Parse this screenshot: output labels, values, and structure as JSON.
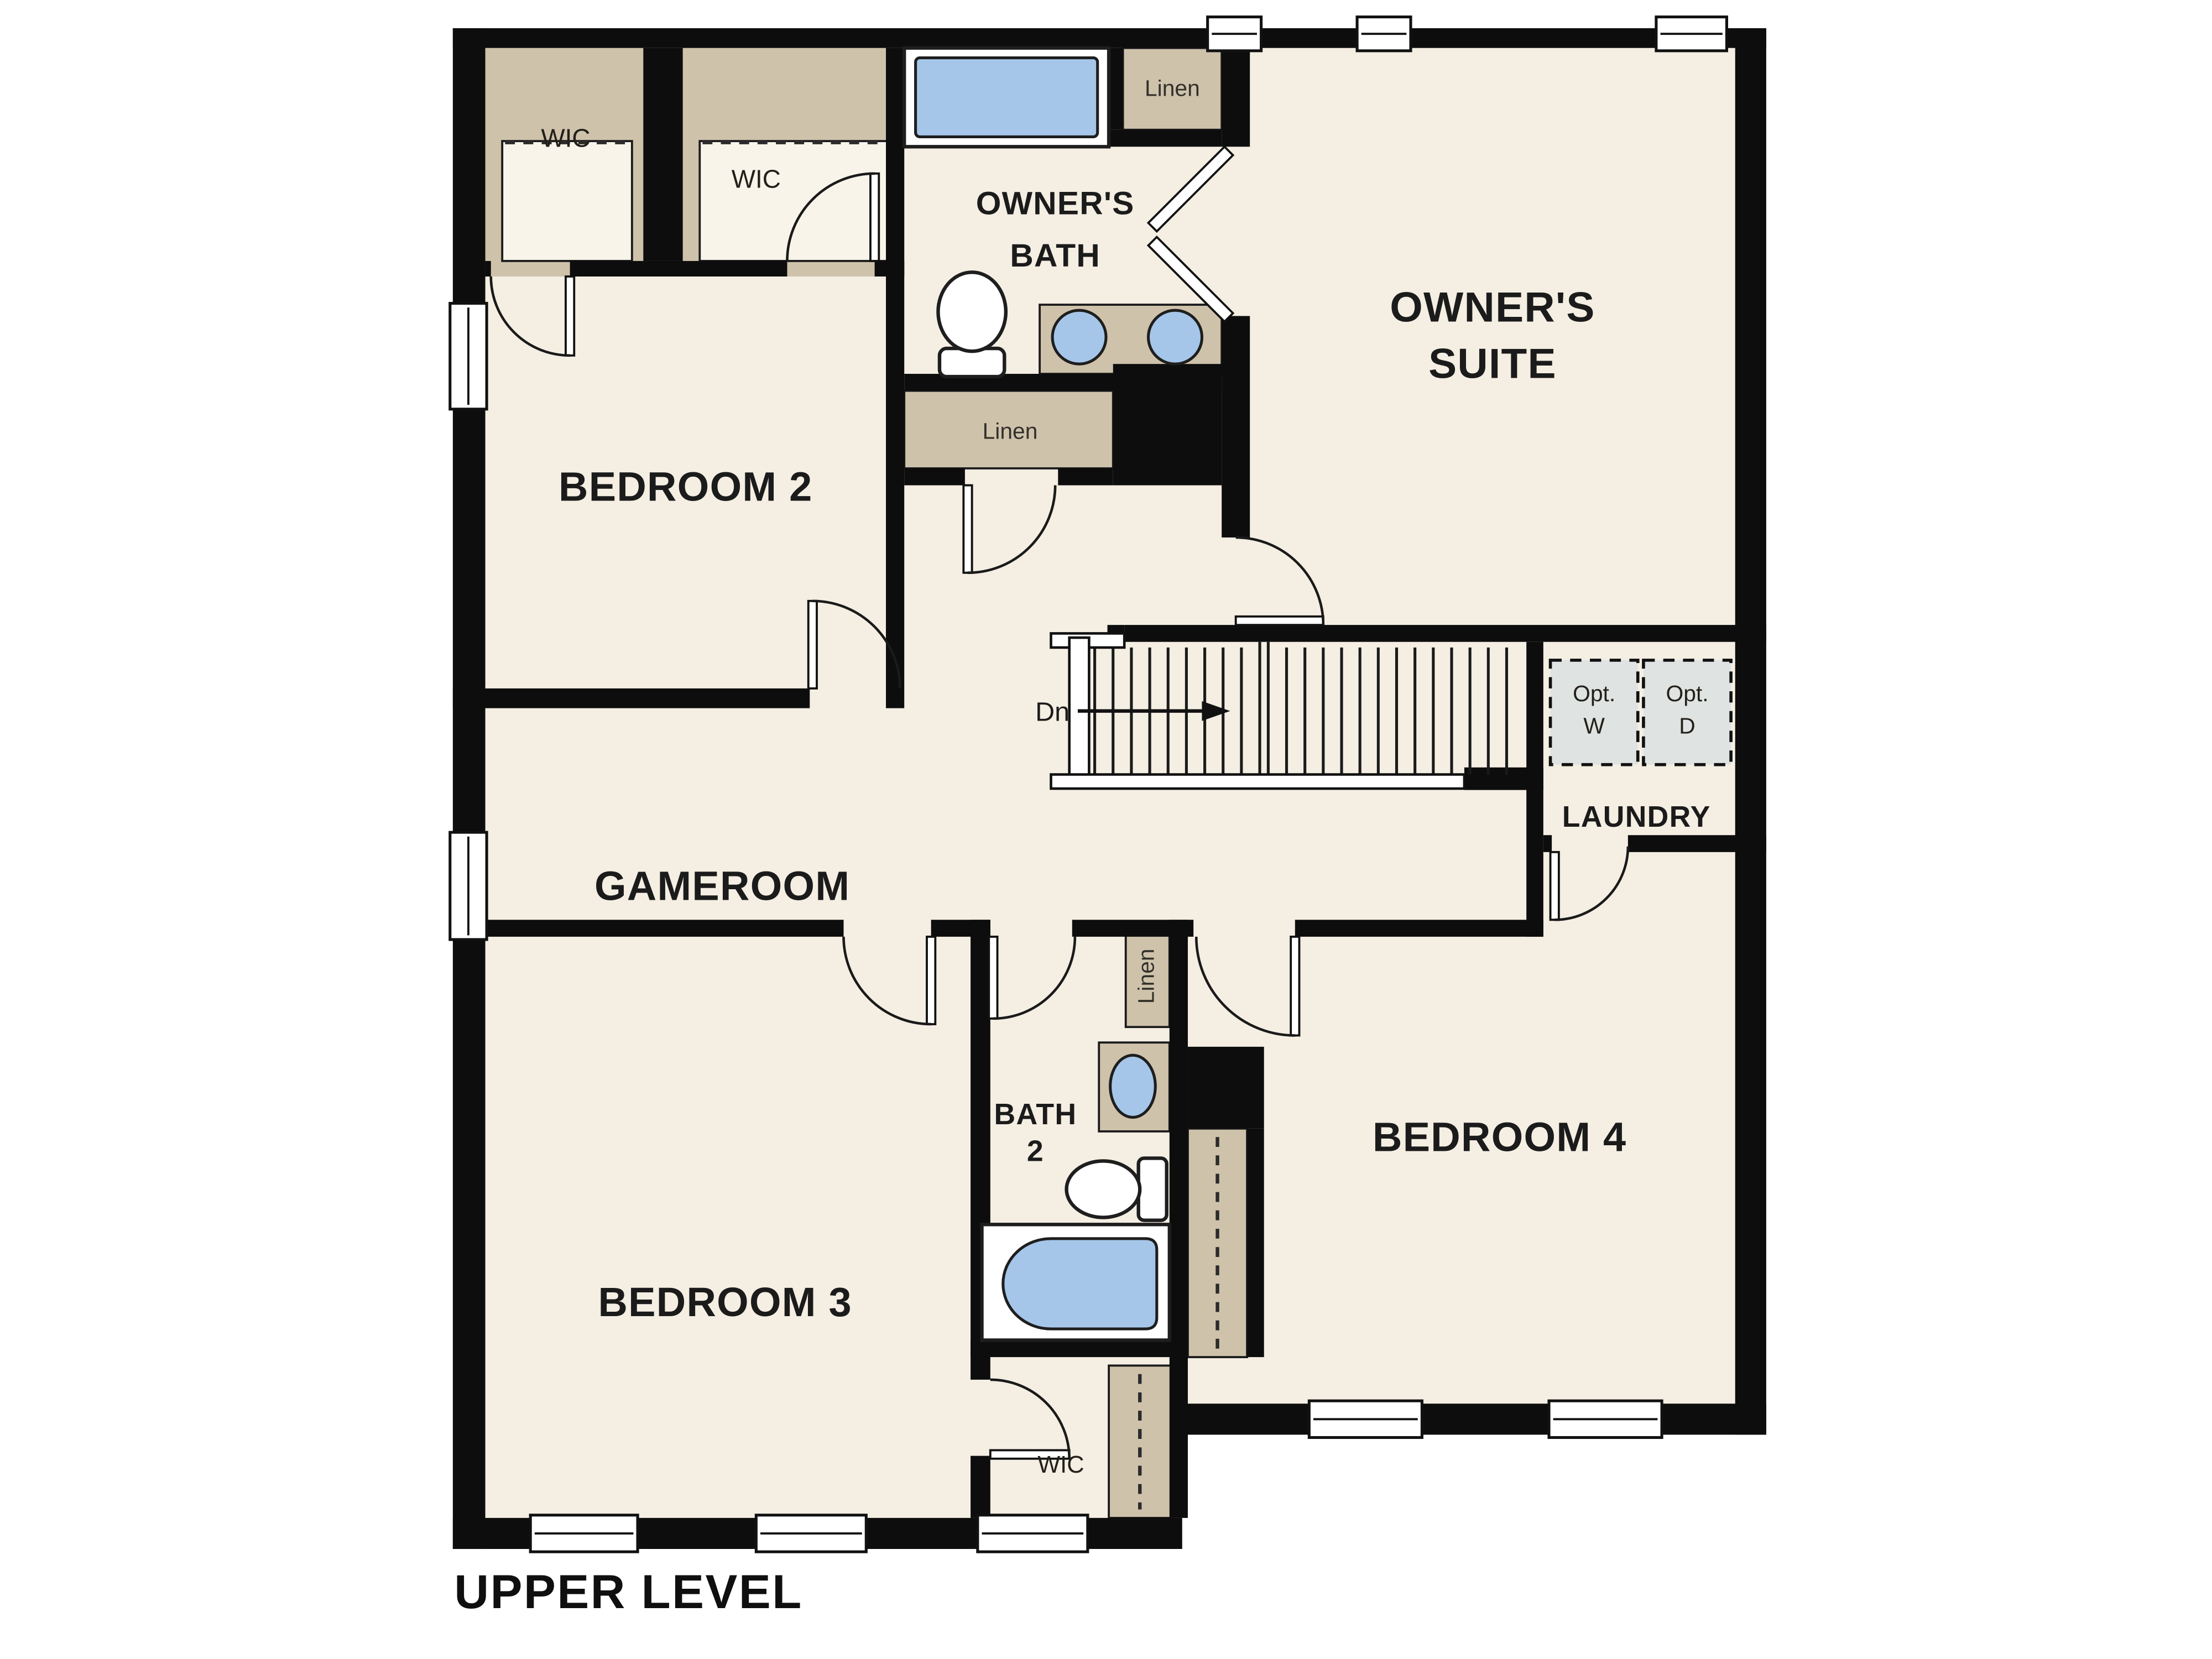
{
  "title": "UPPER LEVEL",
  "plan": {
    "rooms": {
      "owners_suite": {
        "line1": "OWNER'S",
        "line2": "SUITE"
      },
      "owners_bath": {
        "line1": "OWNER'S",
        "line2": "BATH"
      },
      "bedroom2": {
        "label": "BEDROOM 2"
      },
      "bedroom3": {
        "label": "BEDROOM 3"
      },
      "bedroom4": {
        "label": "BEDROOM 4"
      },
      "gameroom": {
        "label": "GAMEROOM"
      },
      "laundry": {
        "label": "LAUNDRY"
      },
      "bath2": {
        "line1": "BATH",
        "line2": "2"
      }
    },
    "closets": {
      "wic_bedroom2_a": {
        "label": "WIC"
      },
      "wic_bedroom2_b": {
        "label": "WIC"
      },
      "wic_bedroom3": {
        "label": "WIC"
      },
      "linen_owners_bath": {
        "label": "Linen"
      },
      "linen_hall": {
        "label": "Linen"
      },
      "linen_bath2": {
        "label": "Linen"
      }
    },
    "stairs": {
      "direction_label": "Dn"
    },
    "appliances": {
      "washer": {
        "line1": "Opt.",
        "line2": "W"
      },
      "dryer": {
        "line1": "Opt.",
        "line2": "D"
      }
    },
    "colors": {
      "floor": "#f4eee3",
      "closet_tan": "#cec2ab",
      "fixture_blue": "#a5c6e9",
      "wall_black": "#0d0d0d",
      "appliance_gray": "#dfe3e1",
      "background": "#ffffff"
    }
  }
}
